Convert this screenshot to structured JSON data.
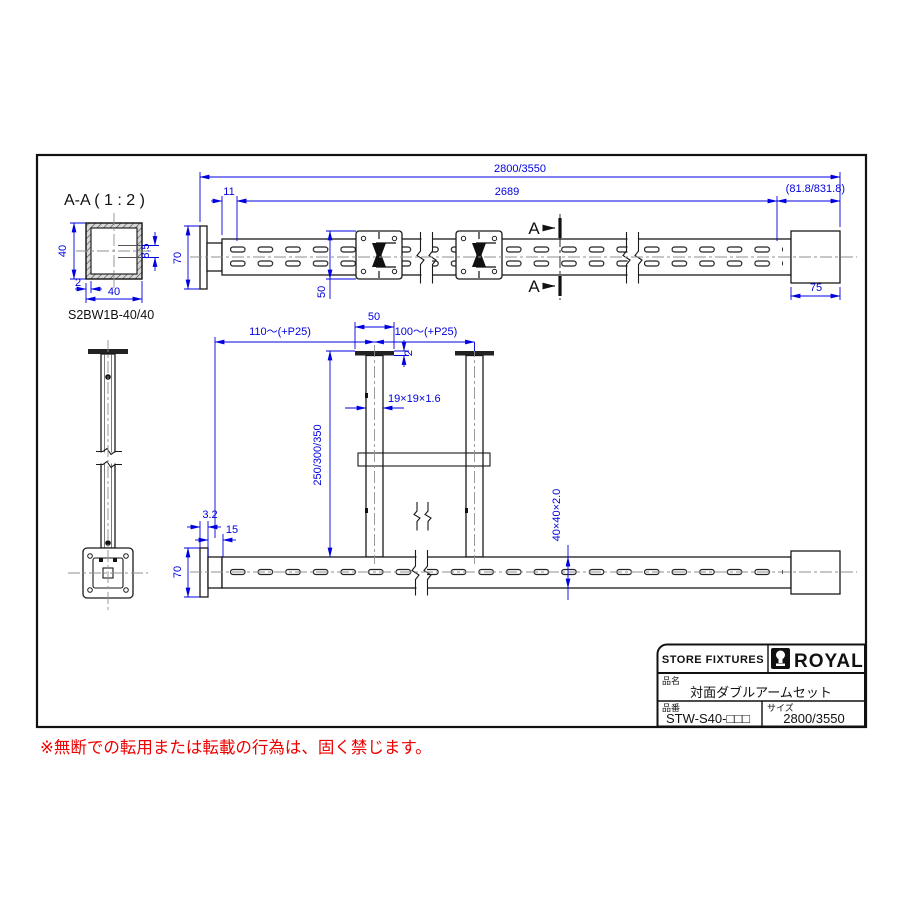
{
  "colors": {
    "dimension": "#0000e0",
    "line": "#1a1a1a",
    "centerline": "#8f8f8f",
    "warning": "#ee0000"
  },
  "aa_view": {
    "title": "A-A ( 1 : 2 )",
    "part": "S2BW1B-40/40",
    "dim_height": "40",
    "dim_width": "40",
    "dim_wall": "2",
    "dim_slot": "8.5"
  },
  "top_view": {
    "dim_overall": "2800/3550",
    "dim_offset": "11",
    "dim_span": "2689",
    "dim_end": "(81.8/831.8)",
    "dim_sleeve": "75",
    "dim_plate": "50",
    "dim_plate_height": "70",
    "section_label": "A"
  },
  "front_view": {
    "dim_pitch_left": "110～(+P25)",
    "dim_flange": "50",
    "dim_pitch_right": "100～(+P25)",
    "dim_flange_thickness": "2",
    "dim_post": "19×19×1.6",
    "dim_height": "250/300/350",
    "dim_tube": "40×40×2.0",
    "dim_plate_thickness": "3.2",
    "dim_inset": "15",
    "dim_plate_height": "70"
  },
  "title_block": {
    "header": "STORE FIXTURES",
    "brand": "ROYAL",
    "name_label": "品名",
    "name": "対面ダブルアームセット",
    "code_label": "品番",
    "code": "STW-S40-□□□",
    "size_label": "サイズ",
    "size": "2800/3550"
  },
  "warning": {
    "text": "※無断での転用または転載の行為は、固く禁じます。"
  }
}
